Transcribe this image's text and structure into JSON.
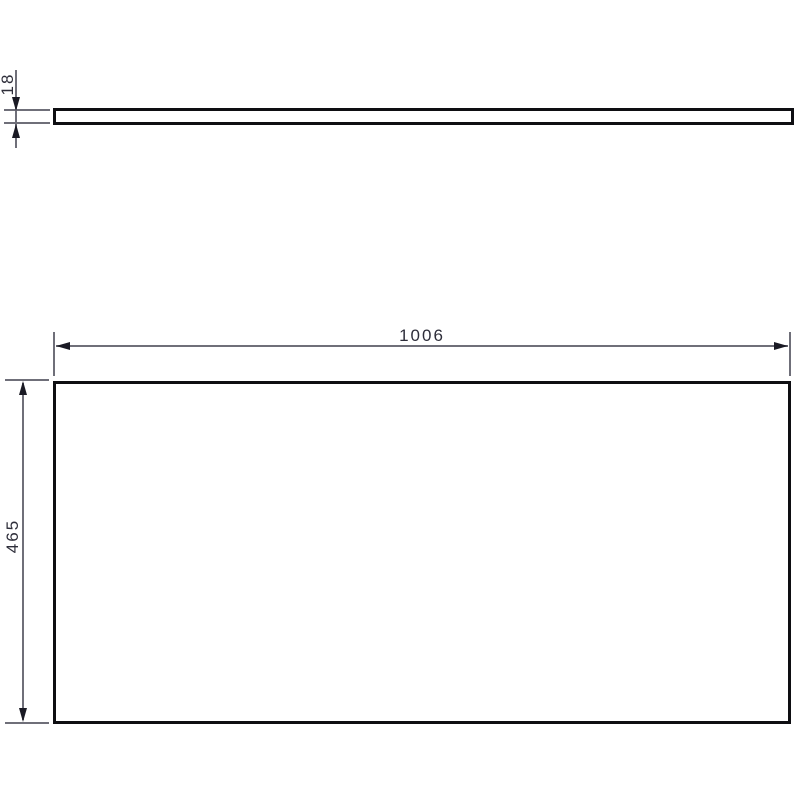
{
  "drawing": {
    "background_color": "#ffffff",
    "outline_color": "#0e0e12",
    "dimension_line_color": "#6f6f79",
    "arrow_color": "#1a1a24",
    "text_color": "#2e2e3a",
    "views": {
      "side_view": {
        "name": "panel edge profile (top)"
      },
      "front_view": {
        "name": "panel front face (bottom)"
      }
    },
    "dimensions": {
      "thickness": {
        "value": "18"
      },
      "width": {
        "value": "1006"
      },
      "height": {
        "value": "465"
      }
    }
  }
}
